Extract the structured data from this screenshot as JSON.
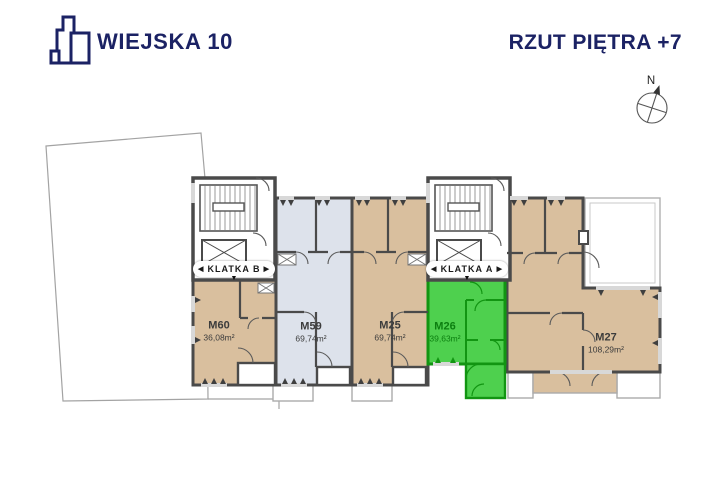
{
  "header": {
    "brand": "WIEJSKA 10",
    "title": "RZUT PIĘTRA +7"
  },
  "compass": {
    "north": "N"
  },
  "staircases": [
    {
      "label": "KLATKA B"
    },
    {
      "label": "KLATKA A"
    }
  ],
  "apartments": [
    {
      "code": "M60",
      "area": "36,08m²",
      "highlighted": false
    },
    {
      "code": "M59",
      "area": "69,74m²",
      "highlighted": false
    },
    {
      "code": "M25",
      "area": "69,74m²",
      "highlighted": false
    },
    {
      "code": "M26",
      "area": "39,63m²",
      "highlighted": true
    },
    {
      "code": "M27",
      "area": "108,29m²",
      "highlighted": false
    }
  ],
  "icons": {
    "arrow_left": "◀",
    "arrow_right": "▶",
    "arrow_down": "▼"
  },
  "colors": {
    "brand_navy": "#1b2264",
    "wall": "#4a4a4a",
    "apartment_tan": "#d9bf9e",
    "apartment_gray": "#dde2eb",
    "highlight_green": "#4ed04e",
    "highlight_green_dark": "#129512"
  }
}
